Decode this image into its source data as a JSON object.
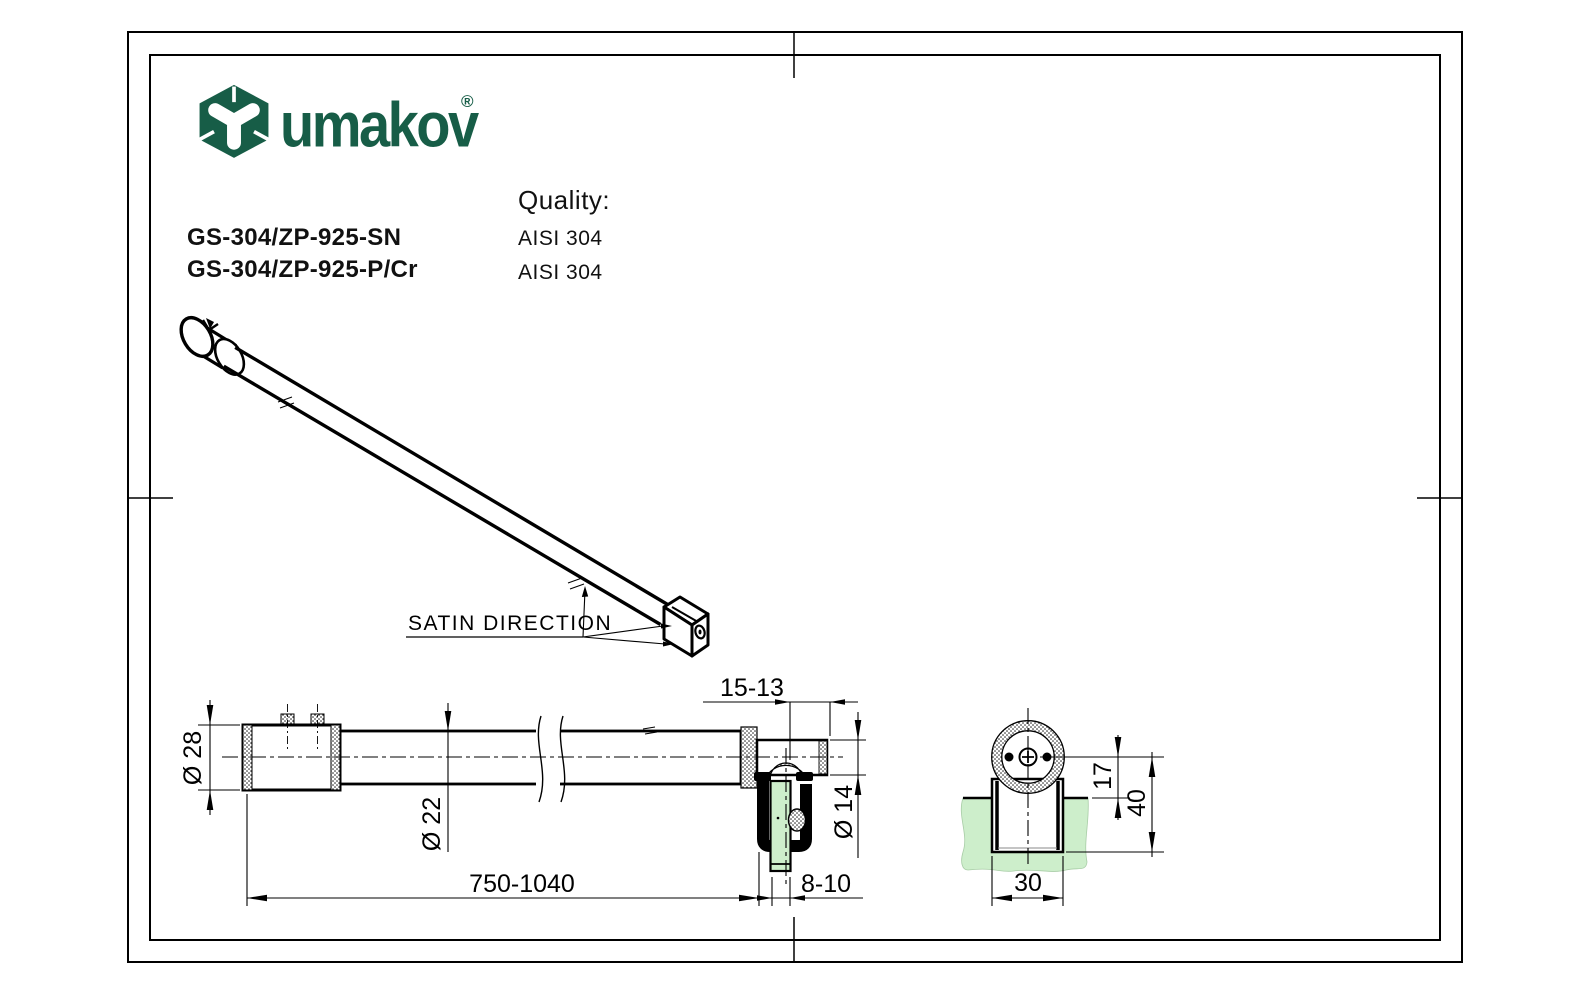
{
  "window": {
    "background": "#ffffff"
  },
  "colors": {
    "brand_green": "#175d47",
    "glass_green": "#cdeecb",
    "line": "#000000"
  },
  "logo": {
    "brand": "umakov",
    "registered": "®"
  },
  "header": {
    "quality_label": "Quality:",
    "products": [
      {
        "code": "GS-304/ZP-925-SN",
        "quality": "AISI 304"
      },
      {
        "code": "GS-304/ZP-925-P/Cr",
        "quality": "AISI 304"
      }
    ]
  },
  "iso_view": {
    "satin_label": "SATIN DIRECTION"
  },
  "side_view": {
    "dim_diameter_outer": "Ø 28",
    "dim_diameter_tube": "Ø 22",
    "dim_diameter_stud": "Ø 14",
    "dim_length": "750-1040",
    "dim_glass_thickness": "8-10",
    "dim_stud_adjust": "15-13"
  },
  "section_view": {
    "dim_center_offset": "17",
    "dim_total_depth": "40",
    "dim_clamp_width": "30"
  }
}
